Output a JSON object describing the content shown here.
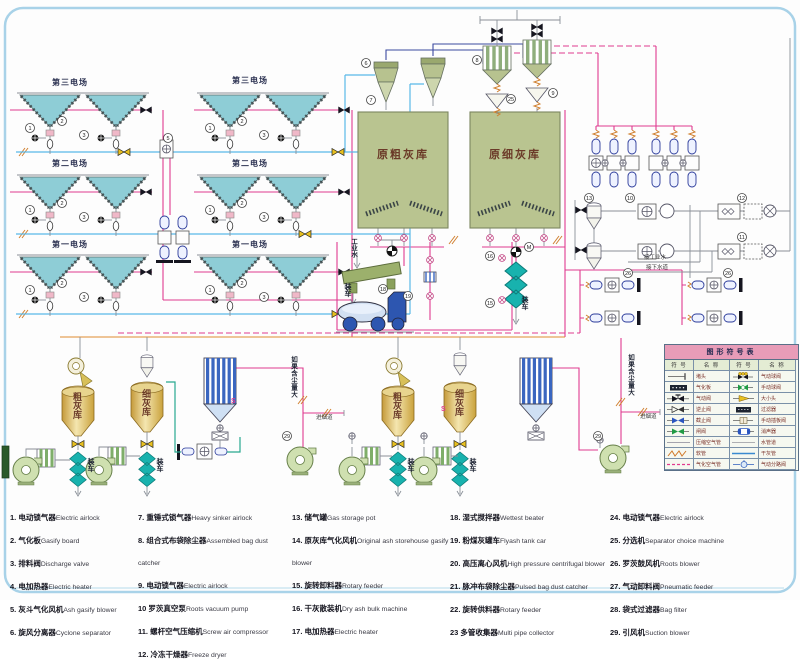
{
  "colors": {
    "ash_pipe_pink": "#e03a90",
    "compressed_air_blue": "#5ab8e8",
    "vacuum_navy": "#3c4aa0",
    "hose_orange": "#e08a30",
    "water_gray": "#8a9098",
    "slurry_green": "#28a890",
    "hopper_teal": "#8ecdd6",
    "silo_olive": "#b9c490",
    "silo_gold": "#d9b96a",
    "loader_teal": "#18b2ae",
    "table_header_pink": "#e89cb8",
    "frame_blue": "#a8d2e8"
  },
  "labels": {
    "field3": "第三电场",
    "field2": "第二电场",
    "field1": "第一电场",
    "raw_coarse_silo": "原粗灰库",
    "raw_fine_silo": "原细灰库",
    "coarse_silo": "粗灰库",
    "fine_silo": "细灰库",
    "loading": "装车",
    "industrial_water": "工业水",
    "to_industrial_water": "接工业水",
    "to_sewer": "接下水道",
    "if_dusty": "如果含尘量大",
    "to_flue": "进烟道",
    "motor": "M",
    "s_mark": "S"
  },
  "legend_table": {
    "title": "图形符号表",
    "col_headers": [
      "符 号",
      "名 称",
      "符 号",
      "名 称"
    ],
    "rows": [
      {
        "ls": "plug",
        "ln": "堵头",
        "rs": "ball_pneu",
        "rn": "气动球阀"
      },
      {
        "ls": "gasify_board",
        "ln": "气化板",
        "rs": "ball_manual",
        "rn": "手动球阀"
      },
      {
        "ls": "pneumatic_valve",
        "ln": "气动阀",
        "rs": "reducer",
        "rn": "大小头"
      },
      {
        "ls": "check_valve",
        "ln": "逆止阀",
        "rs": "filter",
        "rn": "过滤器"
      },
      {
        "ls": "stop_valve",
        "ln": "截止阀",
        "rs": "gate_manual",
        "rn": "手动插板阀"
      },
      {
        "ls": "gate_valve",
        "ln": "闸阀",
        "rs": "muffler",
        "rn": "消声器"
      },
      {
        "ls": "air_line",
        "ln": "压缩空气管",
        "rs": "water_pipe",
        "rn": "水管道"
      },
      {
        "ls": "hose",
        "ln": "软管",
        "rs": "dryash_pipe",
        "rn": "干灰管"
      },
      {
        "ls": "gasify_pipe",
        "ln": "气化空气管",
        "rs": "divert",
        "rn": "气动分路阀"
      }
    ]
  },
  "legend_list": {
    "columns": [
      {
        "width": 128,
        "items": [
          {
            "num": "1.",
            "zh": "电动锁气器",
            "en": "Electric airlock"
          },
          {
            "num": "2.",
            "zh": "气化板",
            "en": "Gasify board"
          },
          {
            "num": "3.",
            "zh": "排料阀",
            "en": "Discharge valve"
          },
          {
            "num": "4.",
            "zh": "电加热器",
            "en": "Electric heater"
          },
          {
            "num": "5.",
            "zh": "灰斗气化风机",
            "en": "Ash gasify blower"
          },
          {
            "num": "6.",
            "zh": "旋风分离器",
            "en": "Cyclone separator"
          }
        ]
      },
      {
        "width": 154,
        "items": [
          {
            "num": "7.",
            "zh": "重锤式锁气器",
            "en": "Heavy sinker airlock"
          },
          {
            "num": "8.",
            "zh": "组合式布袋除尘器",
            "en": "Assembled bag dust catcher"
          },
          {
            "num": "9.",
            "zh": "电动锁气器",
            "en": "Electric airlock"
          },
          {
            "num": "10",
            "zh": "罗茨真空泵",
            "en": "Roots vacuum pump"
          },
          {
            "num": "11.",
            "zh": "螺杆空气压缩机",
            "en": "Screw air compressor"
          },
          {
            "num": "12.",
            "zh": "冷冻干燥器",
            "en": "Freeze dryer"
          }
        ]
      },
      {
        "width": 158,
        "items": [
          {
            "num": "13.",
            "zh": "储气罐",
            "en": "Gas storage pot"
          },
          {
            "num": "14.",
            "zh": "原灰库气化风机",
            "en": "Original ash storehouse gasify blower"
          },
          {
            "num": "15.",
            "zh": "旋转卸料器",
            "en": "Rotary feeder"
          },
          {
            "num": "16.",
            "zh": "干灰散装机",
            "en": "Dry ash bulk machine"
          },
          {
            "num": "17.",
            "zh": "电加热器",
            "en": "Electric heater"
          }
        ]
      },
      {
        "width": 160,
        "items": [
          {
            "num": "18.",
            "zh": "湿式搅拌器",
            "en": "Wettest beater"
          },
          {
            "num": "19.",
            "zh": "粉煤灰罐车",
            "en": "Flyash tank car"
          },
          {
            "num": "20.",
            "zh": "高压离心风机",
            "en": "High pressure centrifugal blower"
          },
          {
            "num": "21.",
            "zh": "脉冲布袋除尘器",
            "en": "Pulsed bag dust catcher"
          },
          {
            "num": "22.",
            "zh": "旋转供料器",
            "en": "Rotary feeder"
          },
          {
            "num": "23",
            "zh": "多管收集器",
            "en": "Multi pipe collector"
          }
        ]
      },
      {
        "width": 176,
        "items": [
          {
            "num": "24.",
            "zh": "电动锁气器",
            "en": "Electric airlock"
          },
          {
            "num": "25.",
            "zh": "分选机",
            "en": "Separator choice machine"
          },
          {
            "num": "26.",
            "zh": "罗茨鼓风机",
            "en": "Roots blower"
          },
          {
            "num": "27.",
            "zh": "气动卸料阀",
            "en": "Pneumatic feeder"
          },
          {
            "num": "28.",
            "zh": "袋式过滤器",
            "en": "Bag filter"
          },
          {
            "num": "29.",
            "zh": "引风机",
            "en": "Suction blower"
          }
        ]
      }
    ]
  },
  "callouts": [
    {
      "n": "1",
      "x": 30,
      "y": 128
    },
    {
      "n": "2",
      "x": 62,
      "y": 121
    },
    {
      "n": "3",
      "x": 84,
      "y": 135
    },
    {
      "n": "1",
      "x": 30,
      "y": 210
    },
    {
      "n": "2",
      "x": 62,
      "y": 203
    },
    {
      "n": "3",
      "x": 84,
      "y": 217
    },
    {
      "n": "1",
      "x": 30,
      "y": 290
    },
    {
      "n": "2",
      "x": 62,
      "y": 283
    },
    {
      "n": "3",
      "x": 84,
      "y": 297
    },
    {
      "n": "1",
      "x": 210,
      "y": 128
    },
    {
      "n": "2",
      "x": 242,
      "y": 121
    },
    {
      "n": "3",
      "x": 264,
      "y": 135
    },
    {
      "n": "1",
      "x": 210,
      "y": 210
    },
    {
      "n": "2",
      "x": 242,
      "y": 203
    },
    {
      "n": "3",
      "x": 264,
      "y": 217
    },
    {
      "n": "1",
      "x": 210,
      "y": 290
    },
    {
      "n": "2",
      "x": 242,
      "y": 283
    },
    {
      "n": "3",
      "x": 264,
      "y": 297
    },
    {
      "n": "5",
      "x": 168,
      "y": 138
    },
    {
      "n": "6",
      "x": 366,
      "y": 63
    },
    {
      "n": "7",
      "x": 371,
      "y": 100
    },
    {
      "n": "8",
      "x": 477,
      "y": 60
    },
    {
      "n": "25",
      "x": 511,
      "y": 99
    },
    {
      "n": "9",
      "x": 553,
      "y": 93
    },
    {
      "n": "13",
      "x": 589,
      "y": 198
    },
    {
      "n": "10",
      "x": 630,
      "y": 198
    },
    {
      "n": "12",
      "x": 742,
      "y": 198
    },
    {
      "n": "11",
      "x": 742,
      "y": 237
    },
    {
      "n": "18",
      "x": 383,
      "y": 289
    },
    {
      "n": "19",
      "x": 408,
      "y": 296
    },
    {
      "n": "16",
      "x": 490,
      "y": 256
    },
    {
      "n": "15",
      "x": 490,
      "y": 303
    },
    {
      "n": "M",
      "x": 529,
      "y": 247
    },
    {
      "n": "26",
      "x": 628,
      "y": 273
    },
    {
      "n": "26",
      "x": 728,
      "y": 273
    },
    {
      "n": "29",
      "x": 598,
      "y": 436
    },
    {
      "n": "29",
      "x": 287,
      "y": 436
    }
  ]
}
